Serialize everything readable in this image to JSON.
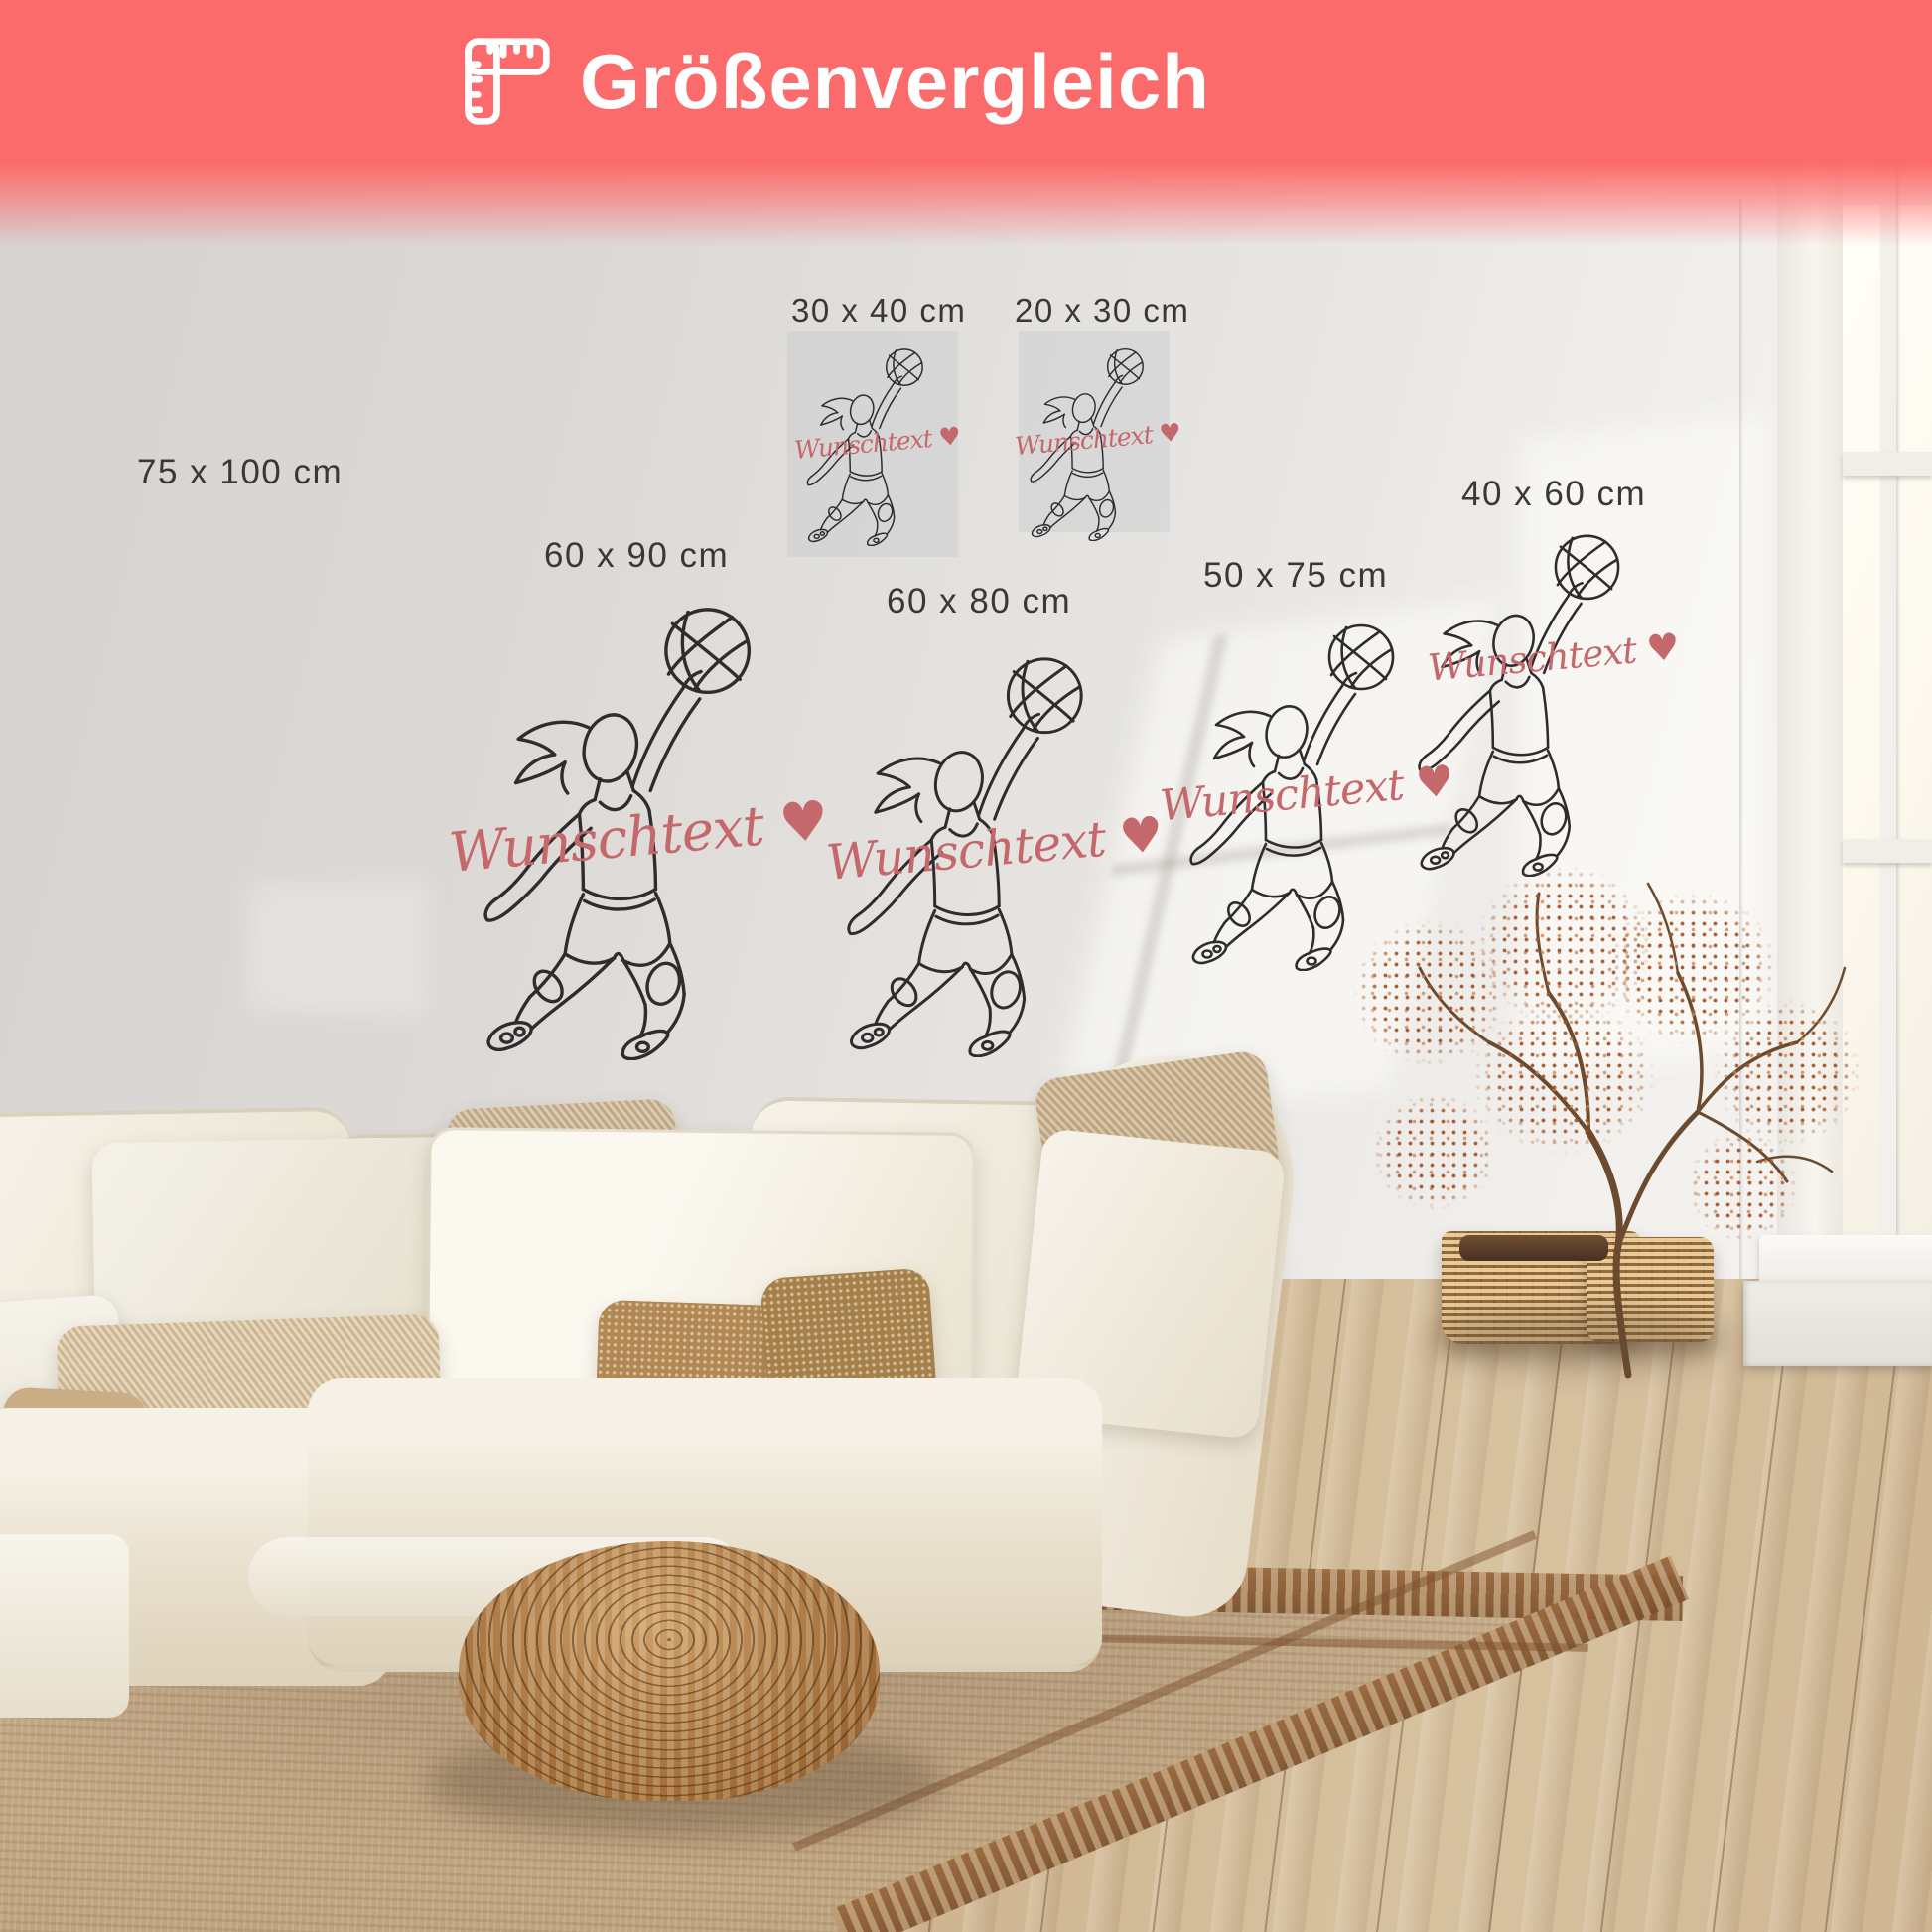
{
  "banner": {
    "title": "Größenvergleich",
    "icon": "folding-ruler-icon",
    "background_color": "#fc6b6b",
    "title_color": "#ffffff"
  },
  "wall_art": {
    "custom_text": "Wunschtext",
    "custom_text_heart": "♥",
    "custom_text_color": "#c4686c",
    "line_art_color": "#2e2c2c",
    "label_color": "#3a3836",
    "motif": "basketball-player-one-line-art",
    "sizes": [
      {
        "id": "75x100",
        "label": "75 x 100 cm"
      },
      {
        "id": "30x40",
        "label": "30 x 40 cm"
      },
      {
        "id": "20x30",
        "label": "20 x 30 cm"
      },
      {
        "id": "60x90",
        "label": "60 x 90 cm"
      },
      {
        "id": "60x80",
        "label": "60 x 80 cm"
      },
      {
        "id": "50x75",
        "label": "50 x 75 cm"
      },
      {
        "id": "40x60",
        "label": "40 x 60 cm"
      }
    ]
  },
  "scene": {
    "room": "living room with cream sofa, rattan pouf, jute rug, dried tree in wicker baskets, white window",
    "wall_color": "#e7e5e2",
    "floor_color": "#cbb08a"
  }
}
